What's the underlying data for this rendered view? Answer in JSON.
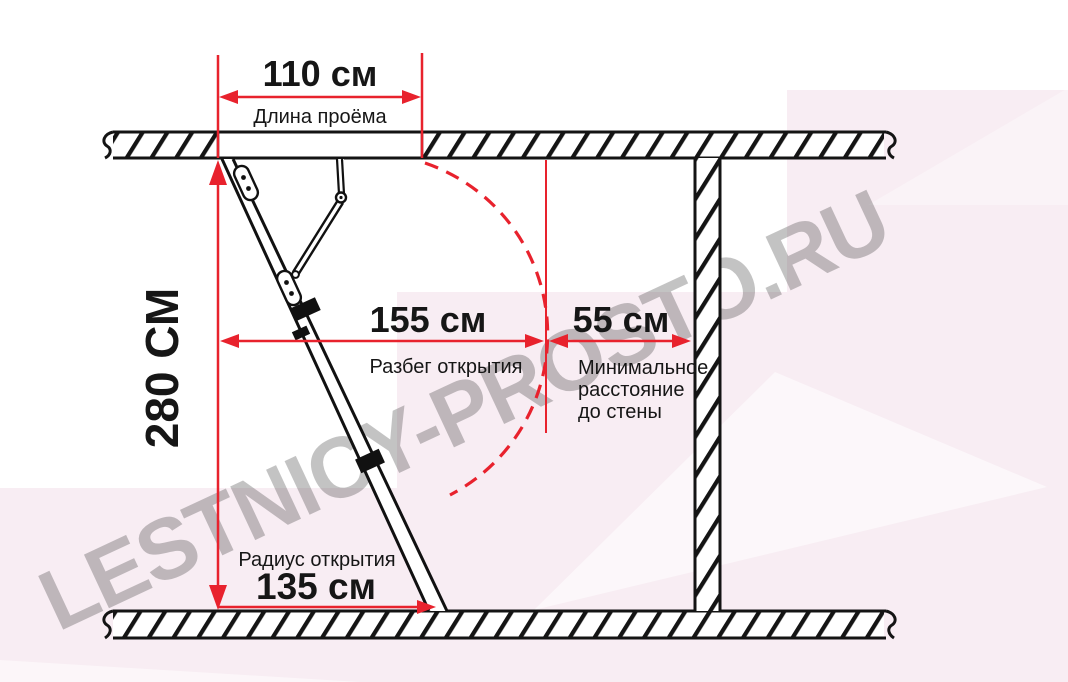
{
  "title": "Схема размеров чердачной лестницы",
  "watermark": "LESTNICY-PROSTO.RU",
  "colors": {
    "dimension_red": "#e8222d",
    "pink_background": "#f8edf3",
    "line_black": "#141414",
    "watermark_gray": "#b89aa8"
  },
  "dimensions": {
    "opening_length": {
      "value": "110 см",
      "label": "Длина проёма"
    },
    "ceiling_height": {
      "value": "280 СМ"
    },
    "opening_span": {
      "value": "155 см",
      "label": "Разбег открытия"
    },
    "wall_distance": {
      "value": "55 см",
      "label_line1": "Минимальное",
      "label_line2": "расстояние",
      "label_line3": "до стены"
    },
    "opening_radius": {
      "value": "135 см",
      "label": "Радиус открытия"
    }
  }
}
